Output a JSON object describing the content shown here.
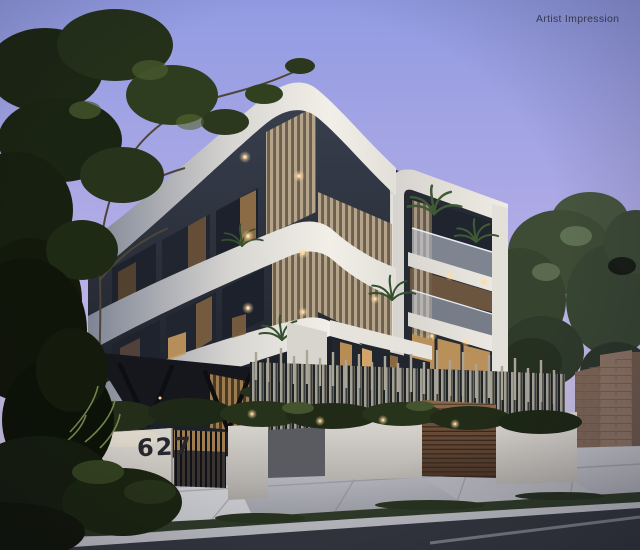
{
  "overlay": {
    "watermark_text": "Artist Impression"
  },
  "property": {
    "street_number": "627"
  },
  "palette": {
    "sky_top": "#929BE2",
    "sky_mid": "#B1ACE6",
    "sky_horizon": "#CFC5E4",
    "facade_white": "#F2EFE8",
    "facade_shadow": "#7E8494",
    "glass_dark": "#232833",
    "glass_warm": "#B98C54",
    "timber_slats": "#B5A38A",
    "timber_warm": "#9C7B4E",
    "dark_cladding": "#1D2128",
    "garage_door": "#6E4E38",
    "fence_batten": "#A9A698",
    "render_wall": "#D8D4CE",
    "brick": "#8A7163",
    "foliage_dark": "#161F10",
    "foliage_mid": "#3E5230",
    "foliage_light": "#6F814C",
    "footpath": "#B7B8BF",
    "grass_verge": "#2F3A28",
    "road": "#34363F",
    "downlight": "#FFD9A0"
  }
}
